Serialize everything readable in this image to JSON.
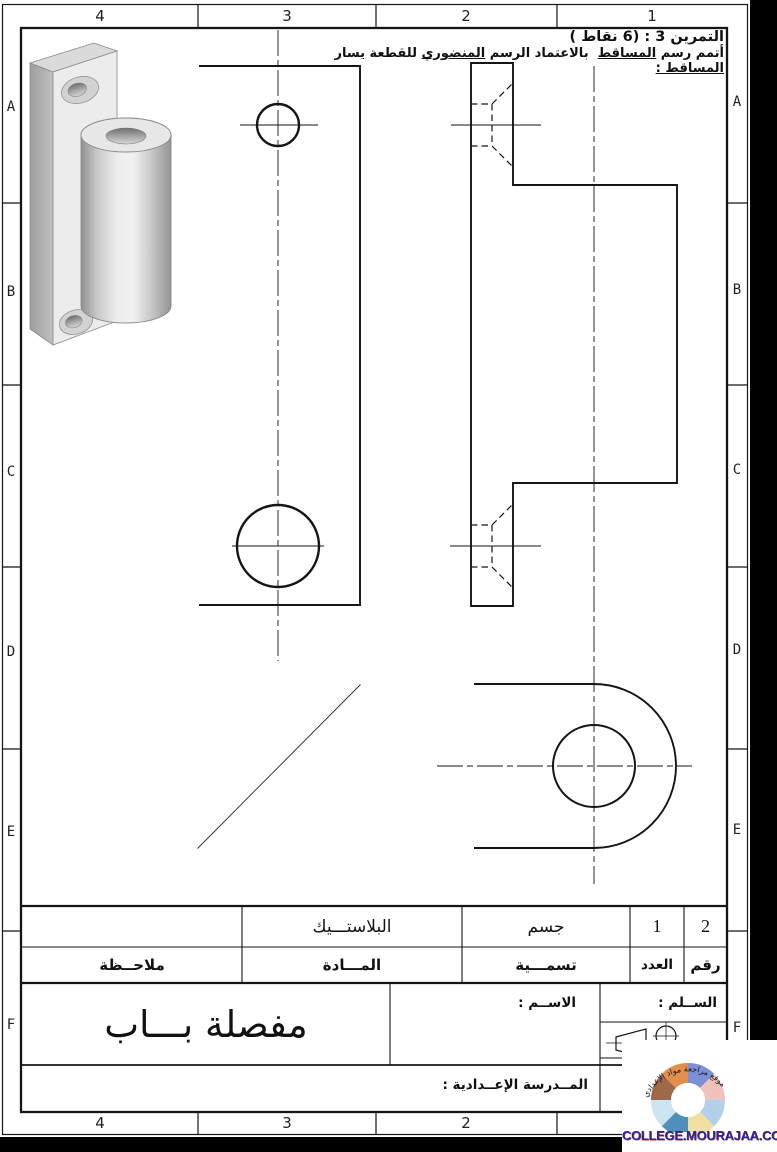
{
  "frame": {
    "cols": [
      "4",
      "3",
      "2",
      "1"
    ],
    "rows": [
      "A",
      "B",
      "C",
      "D",
      "E",
      "F"
    ]
  },
  "exercise": {
    "title": "التمرين 3 : (6 نقاط )",
    "instruction_segments": [
      "أتمم رسم ",
      "المساقط",
      "  بالاعتماد الرسم ",
      "المنضوري",
      " للقطعة يسار ",
      "المساقط :"
    ]
  },
  "title_block": {
    "material_value": "البلاستـــيك",
    "designation_value": "جسم",
    "quantity_value": "1",
    "number_value": "2",
    "note_label": "ملاحــظة",
    "material_label": "المـــادة",
    "designation_label": "تسمـــية",
    "quantity_label": "العدد",
    "number_label": "رقم",
    "part_name": "مفصلة بـــاب",
    "name_label": "الاســم :",
    "scale_label": "الســلم :",
    "school_label": "المــدرسة الإعــدادية :"
  },
  "logo": {
    "site": "COLLEGE.MOURAJAA.COM",
    "arc_text": "موقع مراجعة مواد الإعدادي",
    "site_color": "#26269b"
  }
}
